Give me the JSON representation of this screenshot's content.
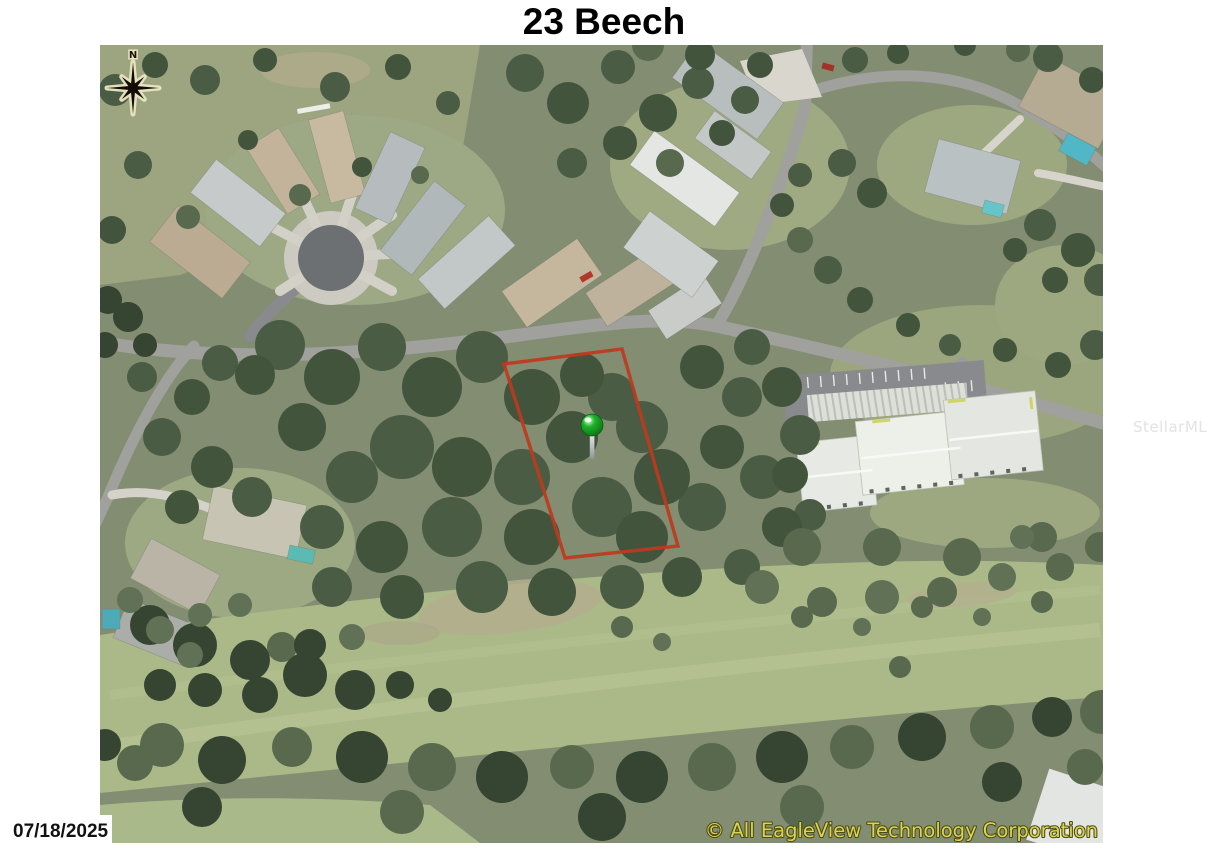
{
  "page": {
    "title": "23 Beech",
    "date_stamp": "07/18/2025",
    "watermark": "StellarMLS"
  },
  "map": {
    "compass_label": "N",
    "copyright_notice": "© All EagleView Technology Corporation",
    "copyright_color": "#d9d552",
    "parcel_outline_color": "#bf3a1d",
    "marker_color": "#1db32b"
  }
}
